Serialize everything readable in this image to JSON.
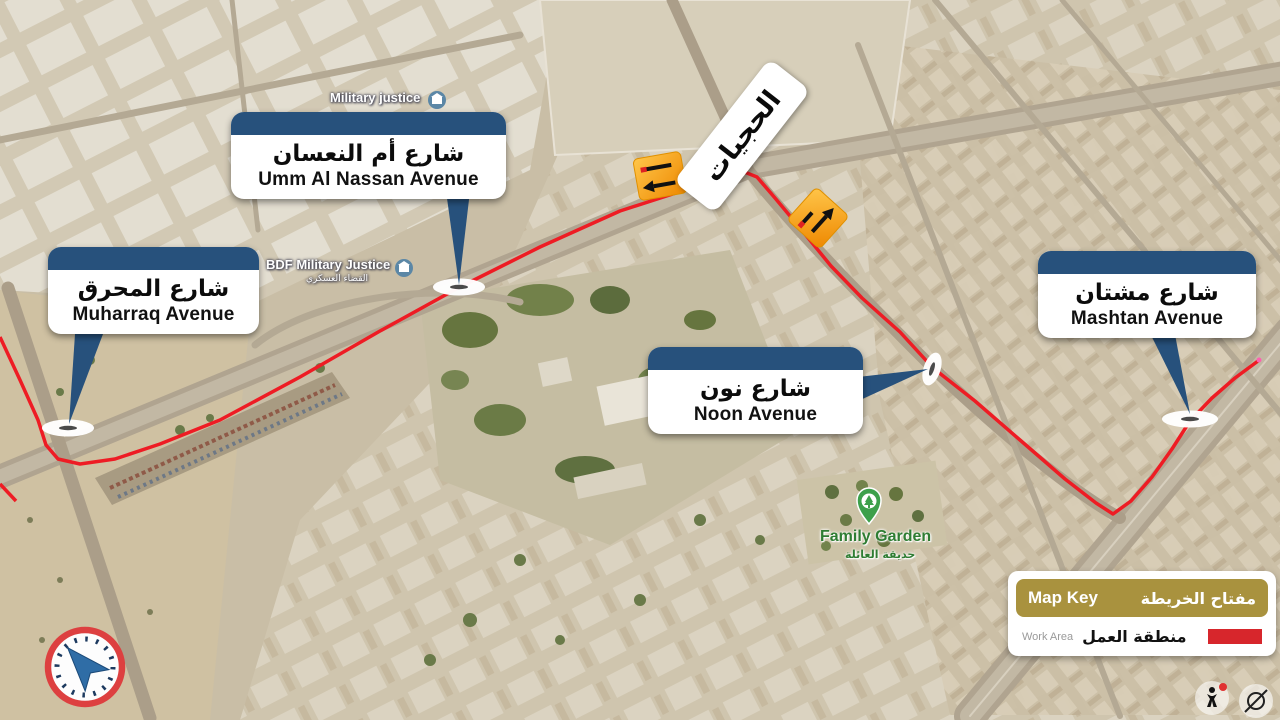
{
  "map": {
    "callouts": [
      {
        "ar": "شارع أم النعسان",
        "en": "Umm Al Nassan Avenue"
      },
      {
        "ar": "شارع المحرق",
        "en": "Muharraq Avenue"
      },
      {
        "ar": "شارع نون",
        "en": "Noon Avenue"
      },
      {
        "ar": "شارع مشتان",
        "en": "Mashtan Avenue"
      }
    ],
    "place_labels": {
      "military_justice": "Military justice",
      "bdf_military_justice": "BDF Military Justice",
      "bdf_military_justice_ar": "القضاء العسكري",
      "family_garden": "Family Garden",
      "family_garden_ar": "حديقة العائلة",
      "al_hajiyat_ar": "الحجيات",
      "al_hajiyat_en": "Al Hajiyat"
    },
    "legend": {
      "title_en": "Map Key",
      "title_ar": "مفتاح الخريطة",
      "items": [
        {
          "label_en": "Work Area",
          "label_ar": "منطقة العمل",
          "swatch_color": "#d7262c"
        }
      ]
    },
    "route": {
      "color": "#ee1c24",
      "main_points": "0,337 20,380 38,420 46,445 58,459 80,464 115,459 160,444 220,420 300,377 380,331 458,288 540,247 620,211 682,191 722,178 742,171 757,177 775,198 800,228 831,266 862,298 900,332 933,368 975,401 1020,440 1065,479 1096,503 1113,514 1131,501 1152,477 1172,449 1190,421 1212,398 1235,378 1258,361",
      "spur_points": "0,484 16,501"
    },
    "colors": {
      "callout_header": "#27517c",
      "legend_gold": "#a9923e",
      "route_red": "#ee1c24"
    }
  }
}
